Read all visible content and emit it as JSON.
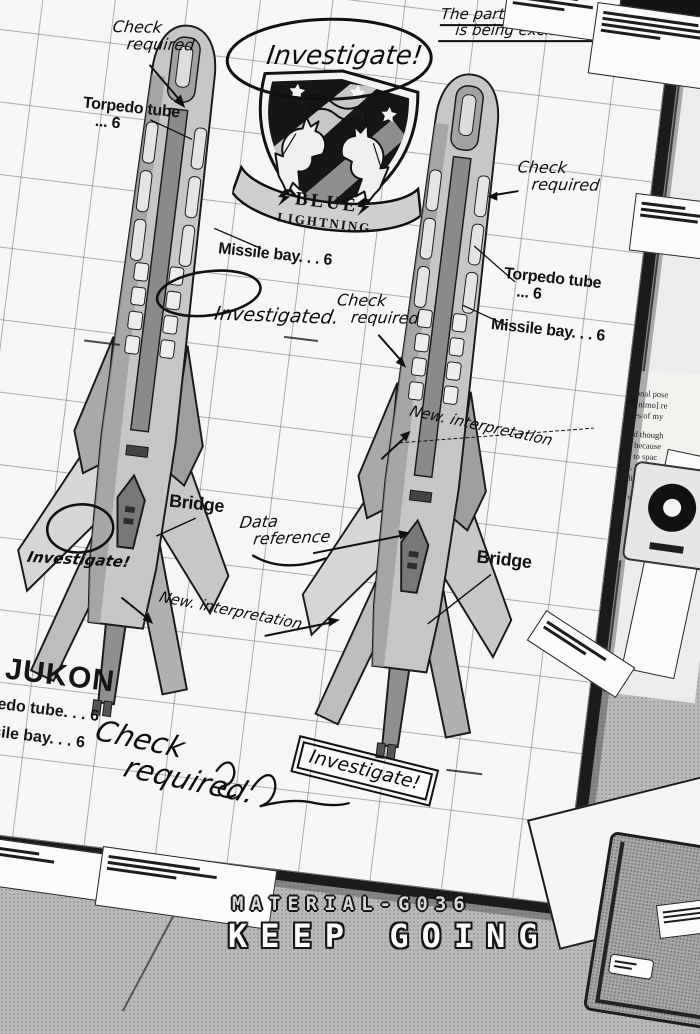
{
  "caption": {
    "code": "MATERIAL-G036",
    "title": "KEEP GOING"
  },
  "emblem": {
    "word_top": "BLUE",
    "word_bottom": "LIGHTNING"
  },
  "ship": {
    "name": "JUKON",
    "labels": {
      "torpedo_tube_line1": "Torpedo tube",
      "torpedo_tube_line2": "... 6",
      "missile_bay": "Missile bay. . . 6",
      "bridge": "Bridge",
      "spec_torpedo": "Torpedo tube. . . 6",
      "spec_missile": "Missile bay. . . 6"
    }
  },
  "annotations": {
    "investigate": "Investigate!",
    "investigated": "Investigated.",
    "uncertainty_line1": "The part of uncertainty",
    "uncertainty_line2": "is being excluded.",
    "check_line1": "Check",
    "check_line2": "required",
    "check_bottom_line1": "Check",
    "check_bottom_line2": "required.",
    "new_interpretation": "New. interpretation",
    "data_reference_line1": "Data",
    "data_reference_line2": "reference"
  },
  "background_page": {
    "fragments": [
      "one hero.",
      "The national pose",
      "was not [nimo] re",
      "objectives of my",
      "It is good though",
      "recalled because",
      "up even to spac",
      "or more. There",
      "race individual",
      "Garma said th"
    ]
  }
}
